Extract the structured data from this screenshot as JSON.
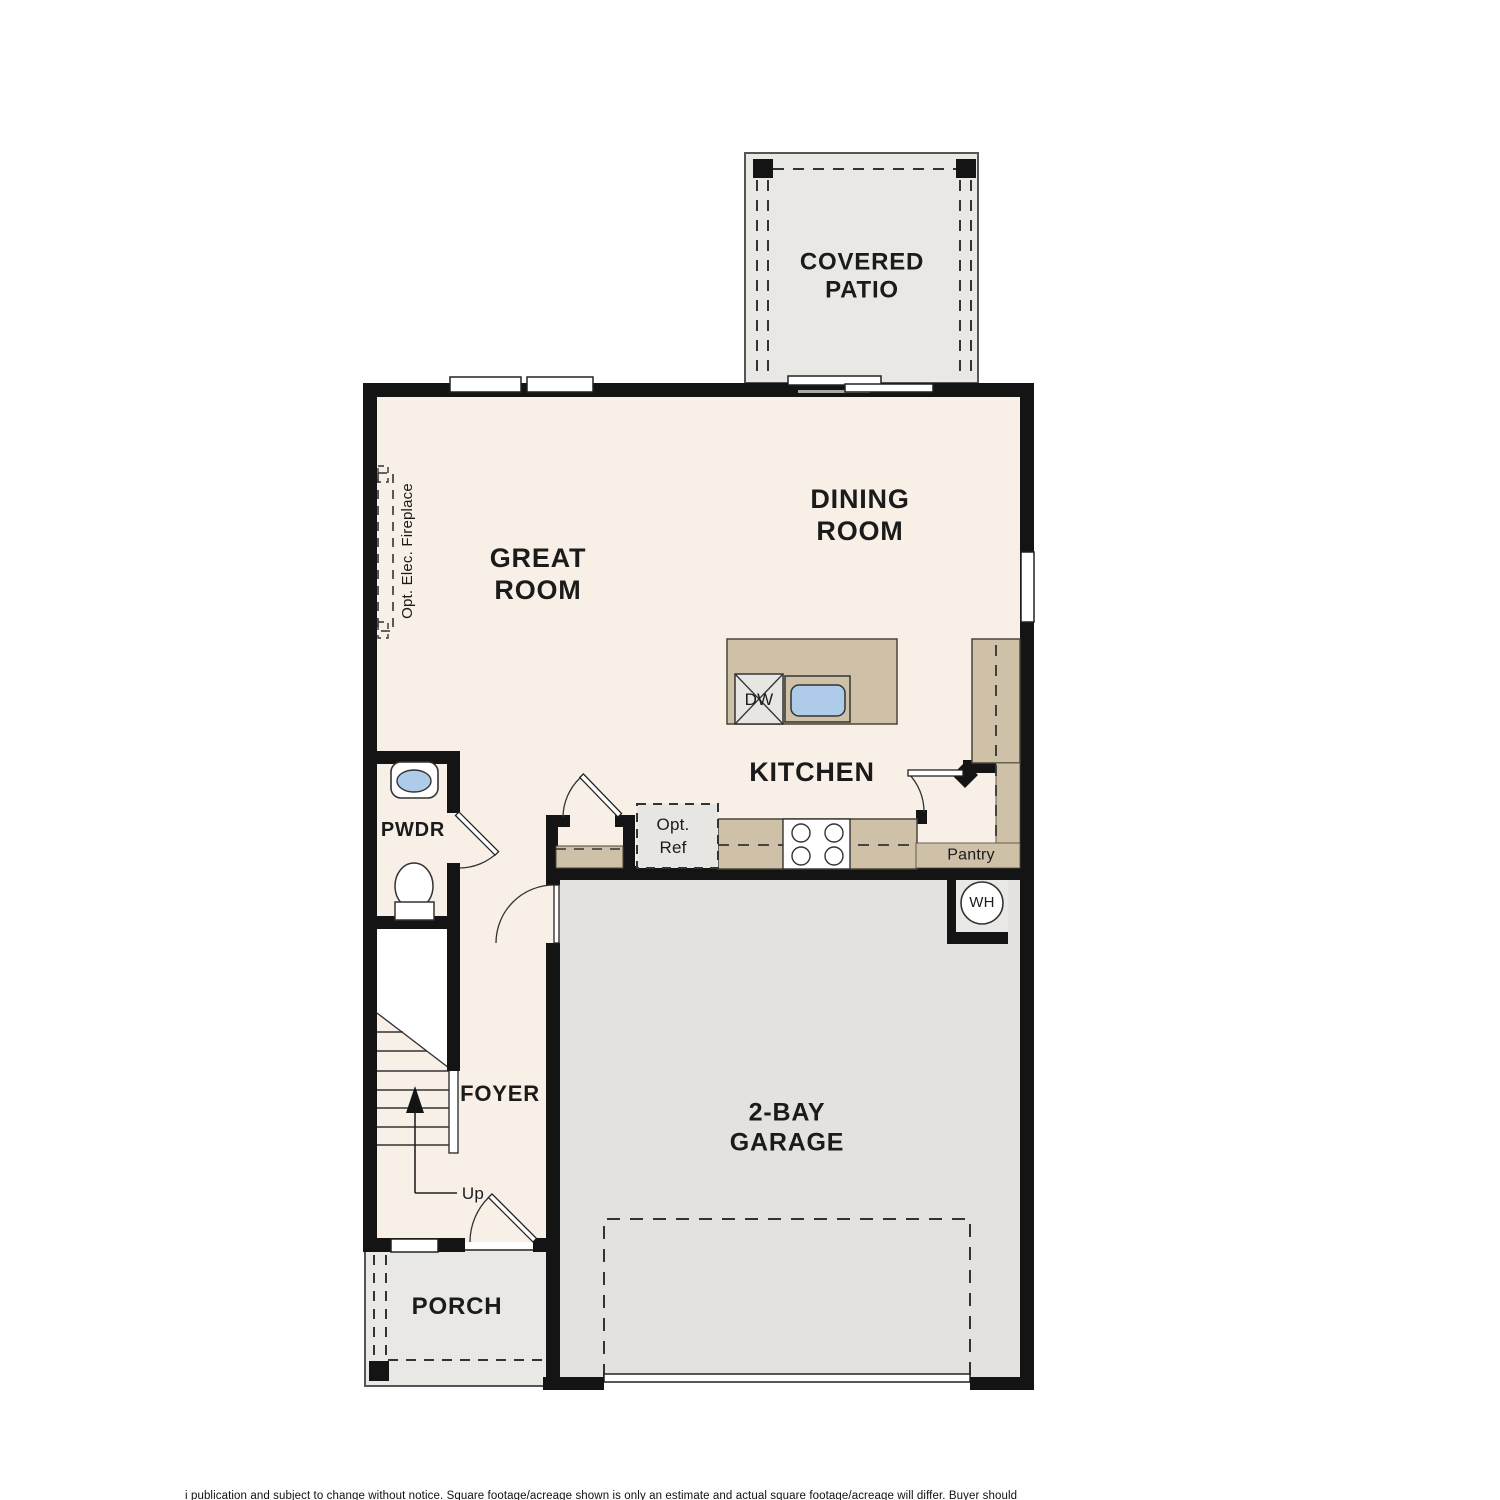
{
  "plan": {
    "rooms": {
      "covered_patio": {
        "label": "COVERED\nPATIO"
      },
      "dining": {
        "label": "DINING\nROOM"
      },
      "great": {
        "label": "GREAT\nROOM"
      },
      "kitchen": {
        "label": "KITCHEN"
      },
      "pwdr": {
        "label": "PWDR"
      },
      "foyer": {
        "label": "FOYER"
      },
      "garage": {
        "label": "2-BAY\nGARAGE"
      },
      "porch": {
        "label": "PORCH"
      },
      "pantry": {
        "label": "Pantry"
      }
    },
    "annotations": {
      "fireplace": {
        "label": "Opt. Elec. Fireplace"
      },
      "opt_ref": {
        "label": "Opt.\nRef"
      },
      "dishwasher": {
        "label": "DW"
      },
      "water_heater": {
        "label": "WH"
      },
      "stairs_up": {
        "label": "Up"
      }
    },
    "colors": {
      "wall": "#141414",
      "interior": "#f8f0e6",
      "counter_tan": "#cfc1a8",
      "patio_gray": "#e9e8e5",
      "garage_gray": "#e3e2df",
      "appliance_gray": "#e7e6e3",
      "sink_blue": "#aecbe9"
    },
    "footer": {
      "disclaimer": "i publication and subject to change without notice. Square footage/acreage shown is only an estimate and actual square footage/acreage will differ. Buyer should"
    }
  }
}
